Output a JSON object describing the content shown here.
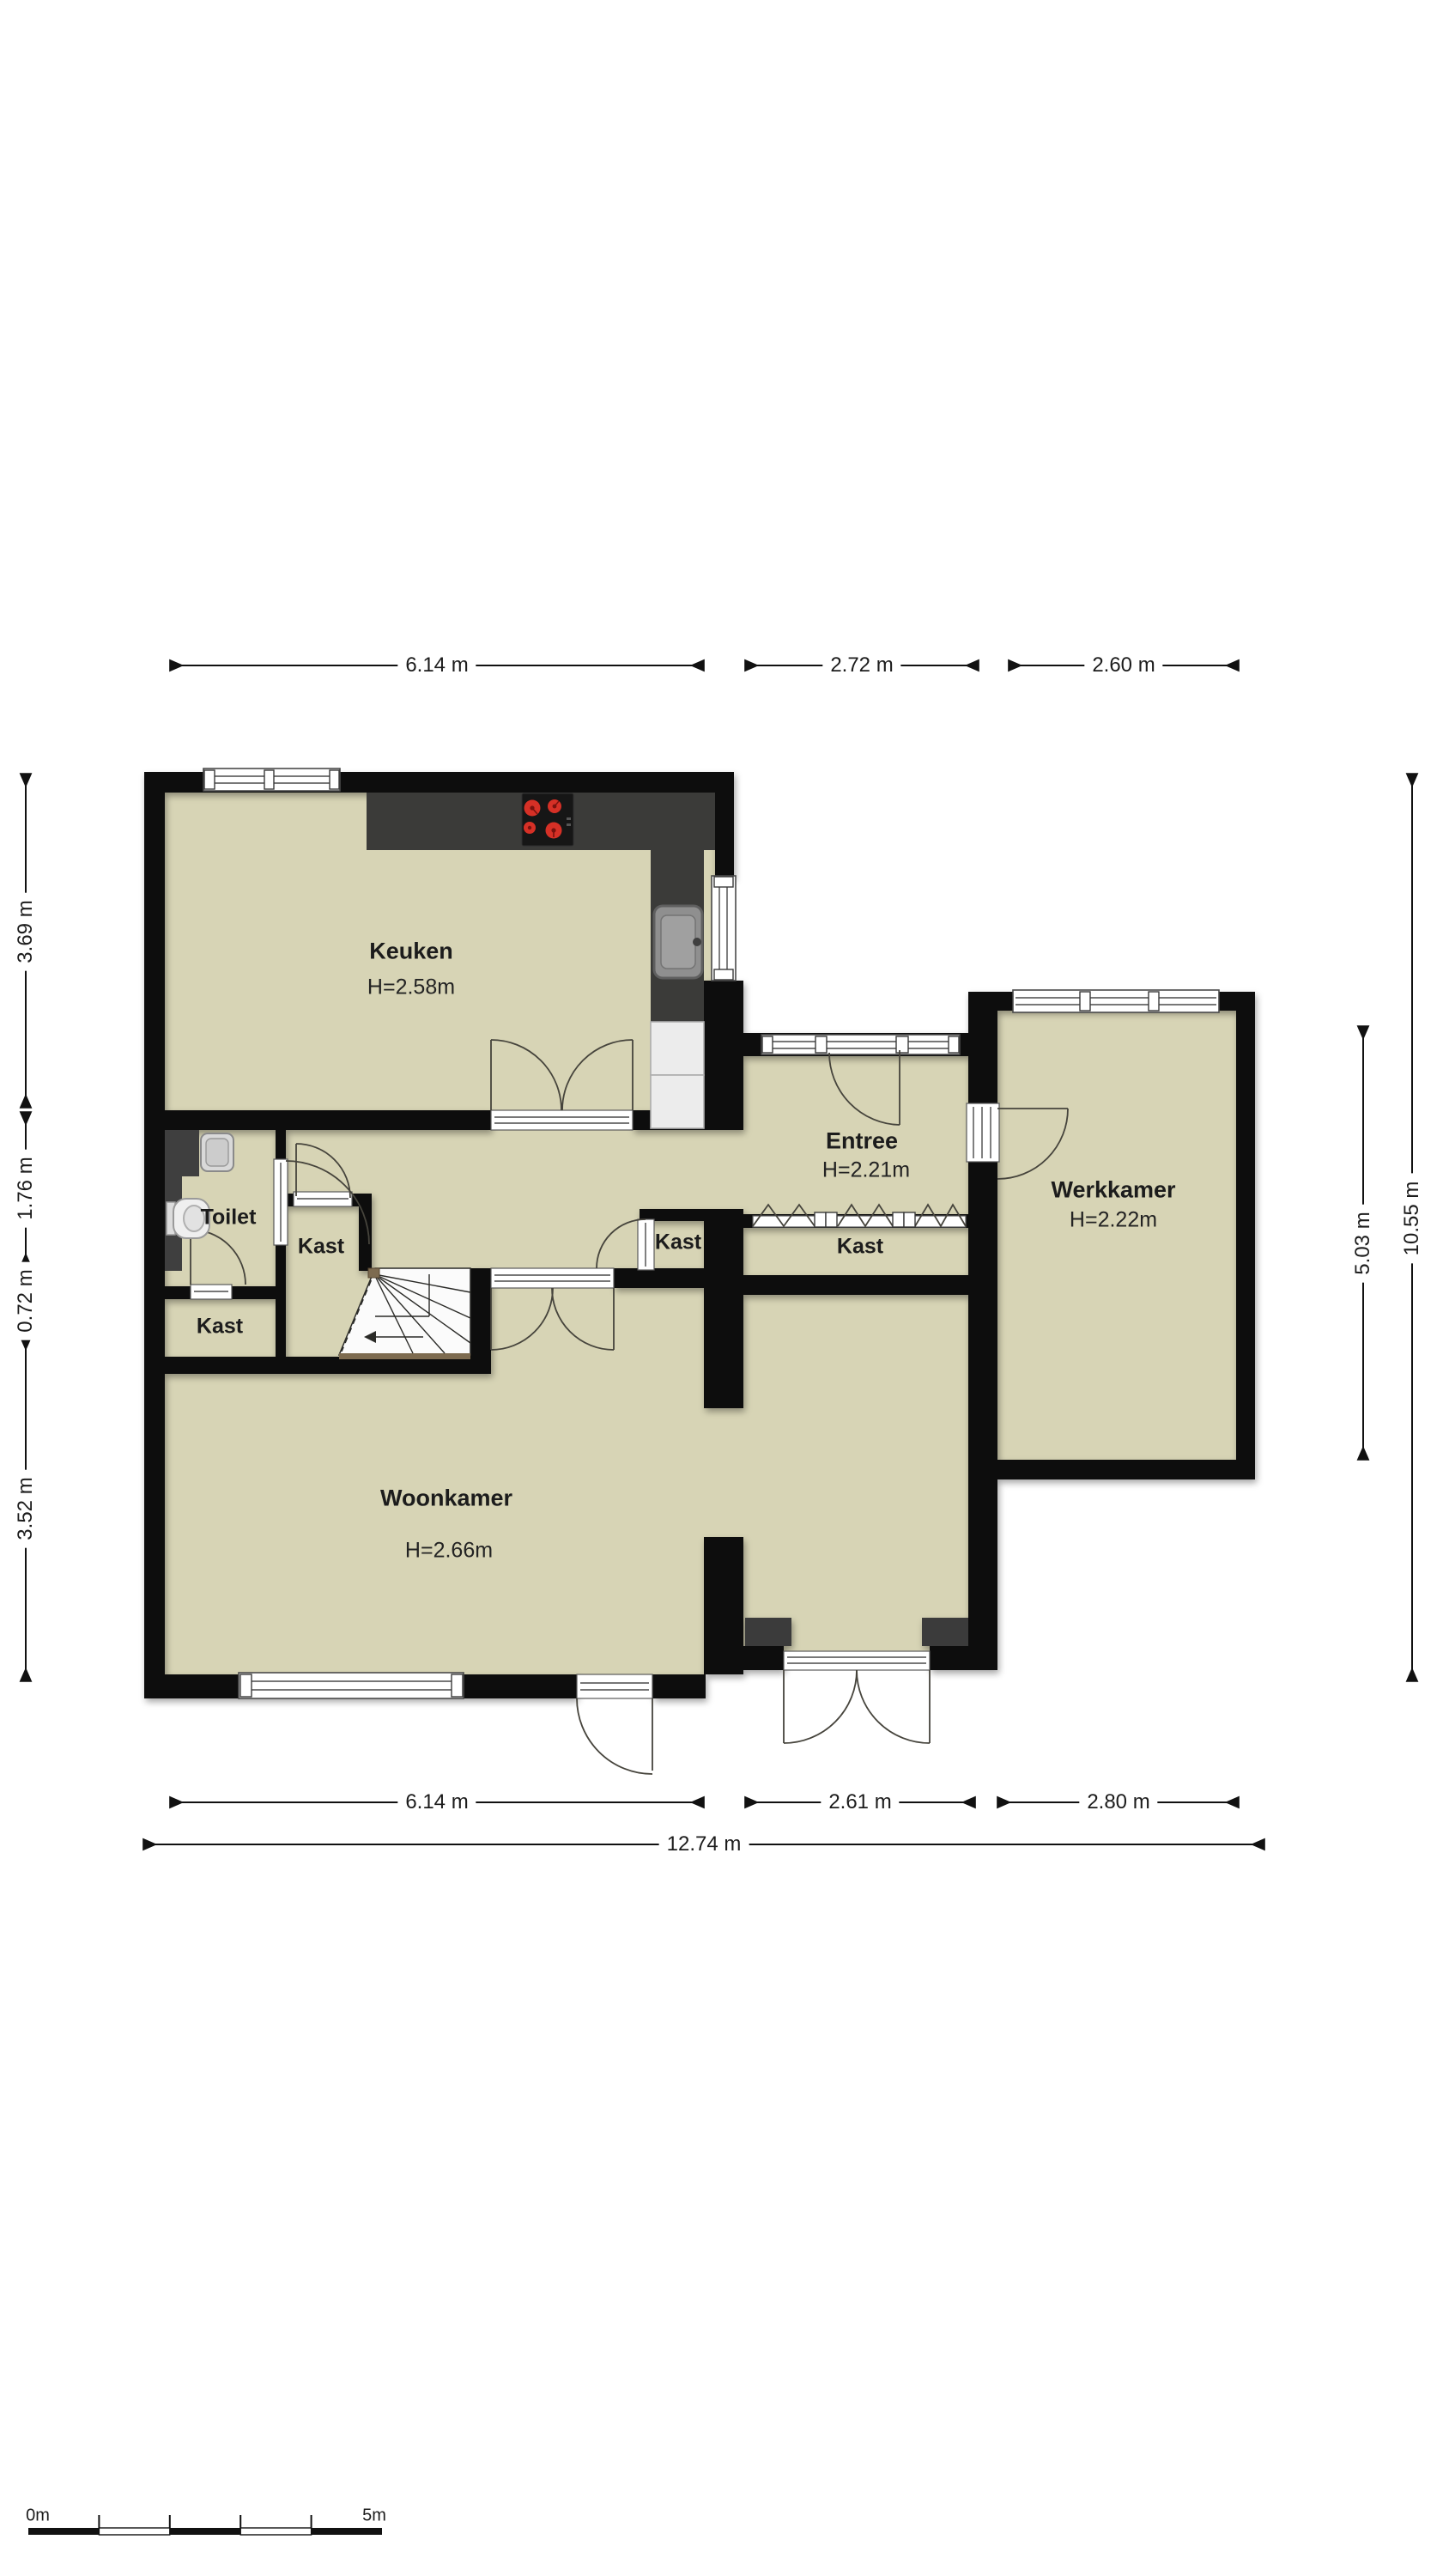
{
  "plan": {
    "rooms": [
      {
        "name": "Keuken",
        "height": "H=2.58m"
      },
      {
        "name": "Entree",
        "height": "H=2.21m"
      },
      {
        "name": "Werkkamer",
        "height": "H=2.22m"
      },
      {
        "name": "Woonkamer",
        "height": "H=2.66m"
      },
      {
        "name": "Toilet"
      },
      {
        "name": "Kast"
      },
      {
        "name": "Kast"
      },
      {
        "name": "Kast"
      },
      {
        "name": "Kast"
      }
    ]
  },
  "dimensions": {
    "top": [
      "6.14 m",
      "2.72 m",
      "2.60 m"
    ],
    "bottom": [
      "6.14 m",
      "2.61 m",
      "2.80 m"
    ],
    "bottom_total": "12.74 m",
    "left": [
      "3.69 m",
      "1.76 m",
      "0.72 m",
      "3.52 m"
    ],
    "right": [
      "5.03 m",
      "10.55 m"
    ]
  },
  "scale_bar": {
    "start": "0m",
    "end": "5m"
  },
  "colors": {
    "wall": "#0e0e0e",
    "floor": "#d7d4b5",
    "counter": "#3b3b39",
    "burner": "#d63026",
    "wood": "#7d6b50",
    "appliance": "#ececec"
  }
}
